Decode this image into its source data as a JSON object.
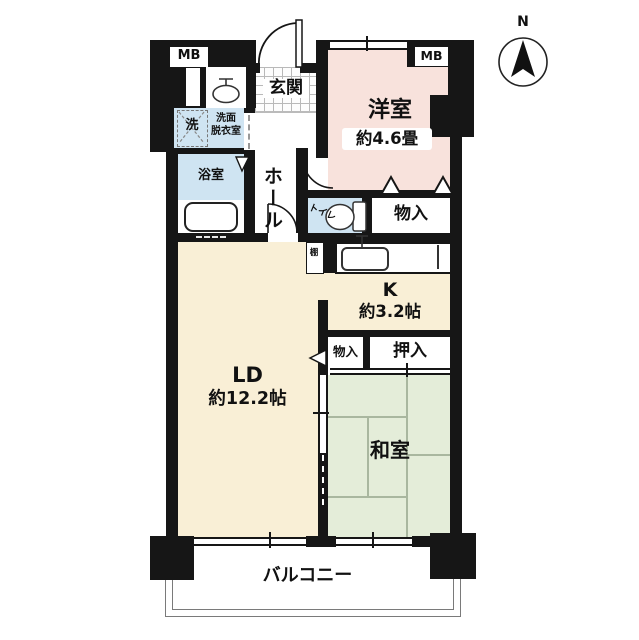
{
  "plan": {
    "compass_label": "N",
    "meter_boxes": {
      "left": "MB",
      "right": "MB"
    },
    "rooms": {
      "entrance": {
        "label": "玄関"
      },
      "western_room": {
        "label": "洋室",
        "size": "約4.6畳"
      },
      "washer": {
        "label": "洗"
      },
      "washroom": {
        "label_line1": "洗面",
        "label_line2": "脱衣室"
      },
      "bathroom": {
        "label": "浴室"
      },
      "hall": {
        "label": "ホール"
      },
      "toilet": {
        "label": "トイレ"
      },
      "storage_top": {
        "label": "物入"
      },
      "shelf": {
        "label": "棚"
      },
      "kitchen": {
        "label": "K",
        "size": "約3.2帖"
      },
      "living_dining": {
        "label": "LD",
        "size": "約12.2帖"
      },
      "storage_mid": {
        "label": "物入"
      },
      "closet": {
        "label": "押入"
      },
      "japanese_room": {
        "label": "和室"
      },
      "balcony": {
        "label": "バルコニー"
      }
    },
    "colors": {
      "wall": "#161616",
      "western_room_fill": "#f8e2dc",
      "wet_area_fill": "#cfe4f2",
      "living_kitchen_fill": "#f9efd6",
      "japanese_room_fill": "#e4edd9"
    }
  }
}
